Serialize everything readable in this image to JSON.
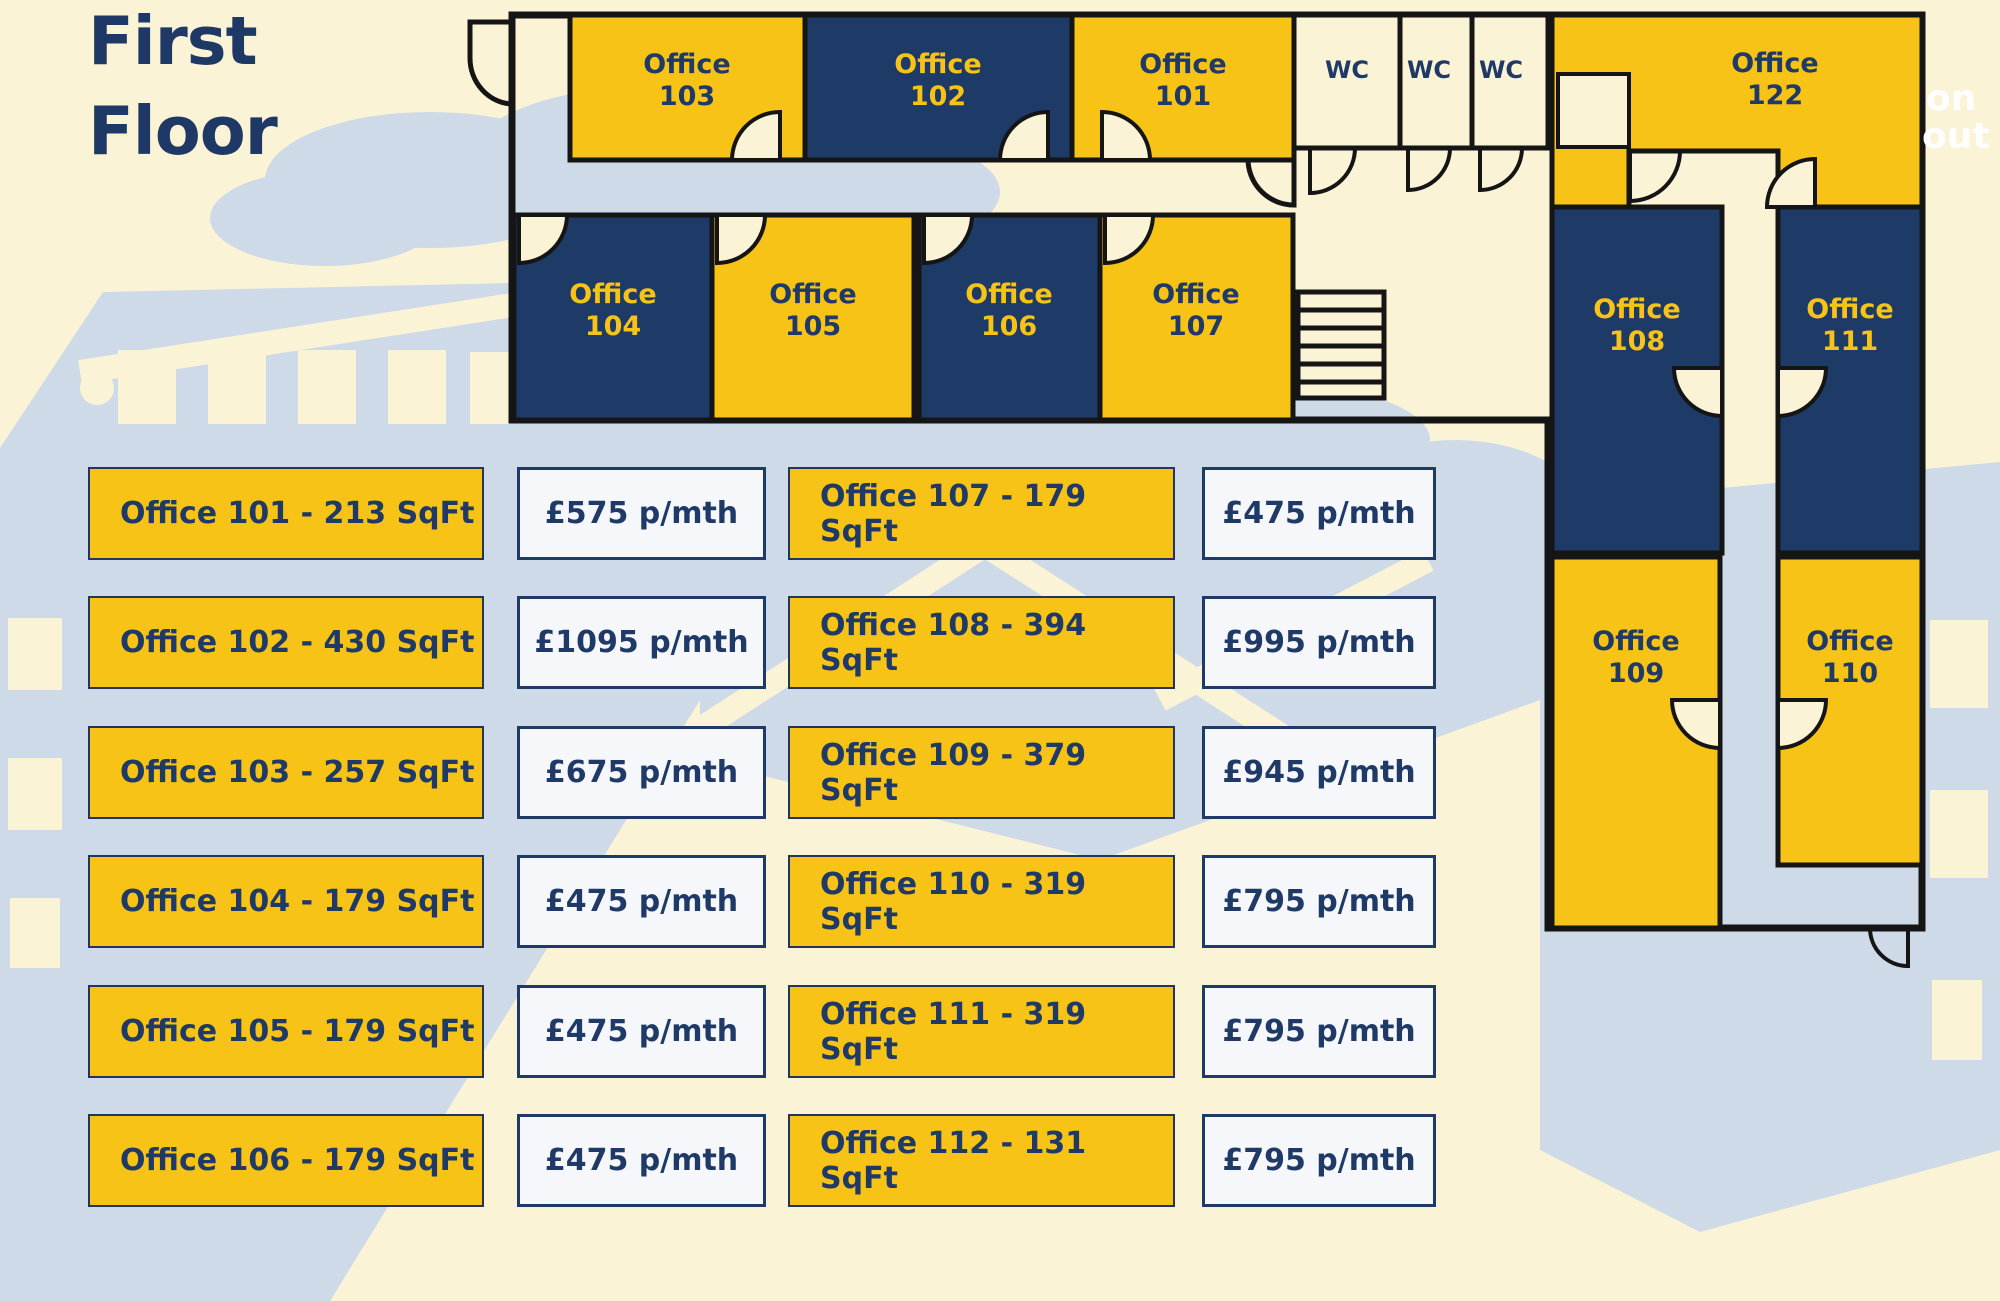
{
  "title": {
    "line1": "First",
    "line2": "Floor"
  },
  "colors": {
    "accent_yellow": "#F6C316",
    "navy": "#1F3A66",
    "cream_background": "#FBF3D6",
    "illustration_blue": "#CEDAE8",
    "price_box_background": "#F5F7FB",
    "wall_black": "#151515"
  },
  "floor_plan": {
    "rooms": {
      "o101": {
        "word": "Office",
        "num": "101"
      },
      "o102": {
        "word": "Office",
        "num": "102"
      },
      "o103": {
        "word": "Office",
        "num": "103"
      },
      "o104": {
        "word": "Office",
        "num": "104"
      },
      "o105": {
        "word": "Office",
        "num": "105"
      },
      "o106": {
        "word": "Office",
        "num": "106"
      },
      "o107": {
        "word": "Office",
        "num": "107"
      },
      "o108": {
        "word": "Office",
        "num": "108"
      },
      "o109": {
        "word": "Office",
        "num": "109"
      },
      "o110": {
        "word": "Office",
        "num": "110"
      },
      "o111": {
        "word": "Office",
        "num": "111"
      },
      "o122": {
        "word": "Office",
        "num": "122"
      },
      "wc1": {
        "label": "WC"
      },
      "wc2": {
        "label": "WC"
      },
      "wc3": {
        "label": "WC"
      }
    },
    "edge_text": {
      "line1": "on",
      "line2": "out"
    }
  },
  "price_list": {
    "rows": [
      {
        "office": "Office 101 - 213 SqFt",
        "price": "£575 p/mth"
      },
      {
        "office": "Office 102 - 430 SqFt",
        "price": "£1095 p/mth"
      },
      {
        "office": "Office 103 - 257 SqFt",
        "price": "£675 p/mth"
      },
      {
        "office": "Office 104 - 179 SqFt",
        "price": "£475 p/mth"
      },
      {
        "office": "Office 105 - 179 SqFt",
        "price": "£475 p/mth"
      },
      {
        "office": "Office 106 - 179 SqFt",
        "price": "£475 p/mth"
      },
      {
        "office": "Office 107 - 179 SqFt",
        "price": "£475 p/mth"
      },
      {
        "office": "Office 108 - 394 SqFt",
        "price": "£995 p/mth"
      },
      {
        "office": "Office 109 - 379 SqFt",
        "price": "£945 p/mth"
      },
      {
        "office": "Office 110 - 319 SqFt",
        "price": "£795 p/mth"
      },
      {
        "office": "Office 111 - 319 SqFt",
        "price": "£795 p/mth"
      },
      {
        "office": "Office 112 - 131 SqFt",
        "price": "£795 p/mth"
      }
    ]
  }
}
